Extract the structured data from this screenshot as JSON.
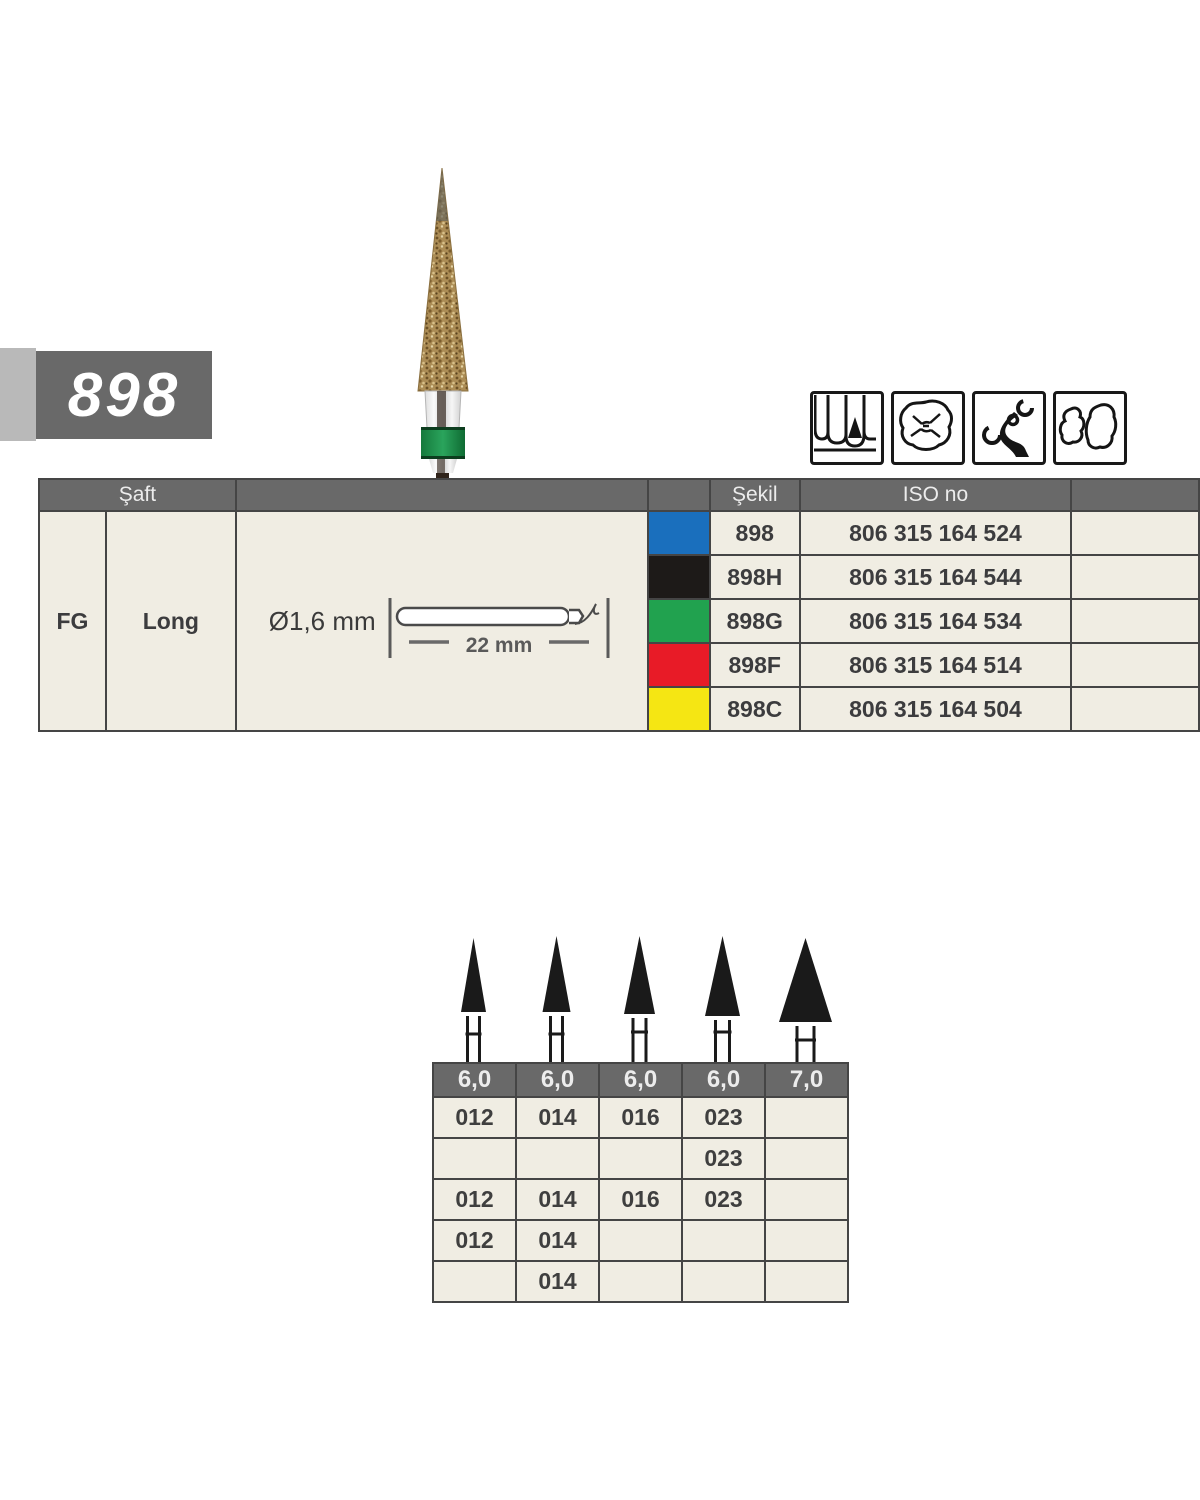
{
  "product": {
    "number": "898"
  },
  "application_icons": [
    {
      "name": "anterior-teeth"
    },
    {
      "name": "occlusal-surface"
    },
    {
      "name": "clasp-adjustment"
    },
    {
      "name": "cavity-shapes"
    }
  ],
  "spec_table": {
    "header": {
      "saft": "Şaft",
      "sekil": "Şekil",
      "iso_no": "ISO no"
    },
    "shaft": {
      "type": "FG",
      "length": "Long",
      "diameter": "Ø1,6 mm",
      "shank_length": "22 mm"
    },
    "rows": [
      {
        "color_name": "blue",
        "color": "#1a6fbd",
        "sekil": "898",
        "iso": "806 315 164 524"
      },
      {
        "color_name": "black",
        "color": "#1d1a18",
        "sekil": "898H",
        "iso": "806 315 164 544"
      },
      {
        "color_name": "green",
        "color": "#21a24f",
        "sekil": "898G",
        "iso": "806 315 164 534"
      },
      {
        "color_name": "red",
        "color": "#e81b27",
        "sekil": "898F",
        "iso": "806 315 164 514"
      },
      {
        "color_name": "yellow",
        "color": "#f5e613",
        "sekil": "898C",
        "iso": "806 315 164 504"
      }
    ]
  },
  "size_table": {
    "columns": [
      "6,0",
      "6,0",
      "6,0",
      "6,0",
      "7,0"
    ],
    "rows": [
      [
        "012",
        "014",
        "016",
        "023",
        ""
      ],
      [
        "",
        "",
        "",
        "023",
        ""
      ],
      [
        "012",
        "014",
        "016",
        "023",
        ""
      ],
      [
        "012",
        "014",
        "",
        "",
        ""
      ],
      [
        "",
        "014",
        "",
        "",
        ""
      ]
    ]
  },
  "colors": {
    "table_header_bg": "#696969",
    "cell_bg": "#f0ede3",
    "border": "#454545",
    "label_bg": "#696969",
    "label_strip": "#b9b9b9",
    "green_band": "#1e8c4a"
  }
}
